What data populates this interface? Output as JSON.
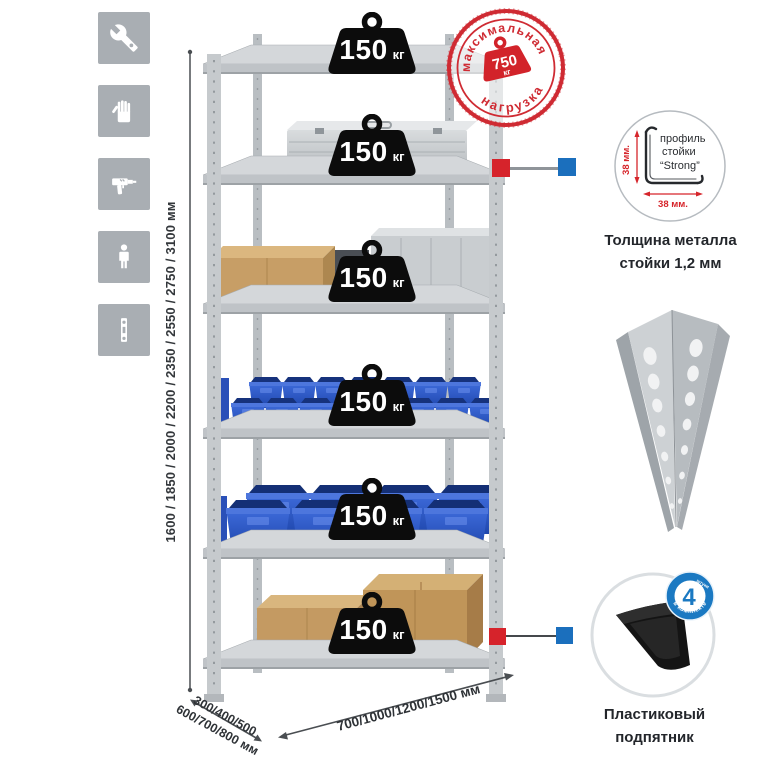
{
  "sidebar": {
    "icons": [
      {
        "name": "wrench"
      },
      {
        "name": "gloves"
      },
      {
        "name": "drill"
      },
      {
        "name": "person"
      },
      {
        "name": "profile-strip"
      }
    ]
  },
  "dimensions": {
    "height": "1600 / 1850 / 2000 / 2200 / 2350 / 2550 / 2750 / 3100 мм",
    "depth_line1": "300/400/500",
    "depth_line2": "600/700/800 мм",
    "width": "700/1000/1200/1500 мм"
  },
  "shelf_load": {
    "value": "150",
    "unit": "кг"
  },
  "max_load_stamp": {
    "top_text": "максимальная",
    "bottom_text": "нагрузка",
    "value": "750",
    "unit": "кг"
  },
  "profile_detail": {
    "label_line1": "профиль",
    "label_line2": "стойки",
    "label_line3": "“Strong”",
    "vertical_dim": "38 мм.",
    "horizontal_dim": "38 мм.",
    "caption_line1": "Толщина металла",
    "caption_line2": "стойки 1,2 мм"
  },
  "foot_detail": {
    "badge_value": "4",
    "badge_qty_word": "штуки",
    "badge_arc_text": "в комплекте",
    "caption_line1": "Пластиковый",
    "caption_line2": "подпятник"
  },
  "colors": {
    "accent_red": "#d6232b",
    "accent_blue": "#1b6fbd",
    "stamp_red": "#cf2b33",
    "bin_blue": "#2f5fce",
    "icon_gray": "#a9aeb3"
  }
}
